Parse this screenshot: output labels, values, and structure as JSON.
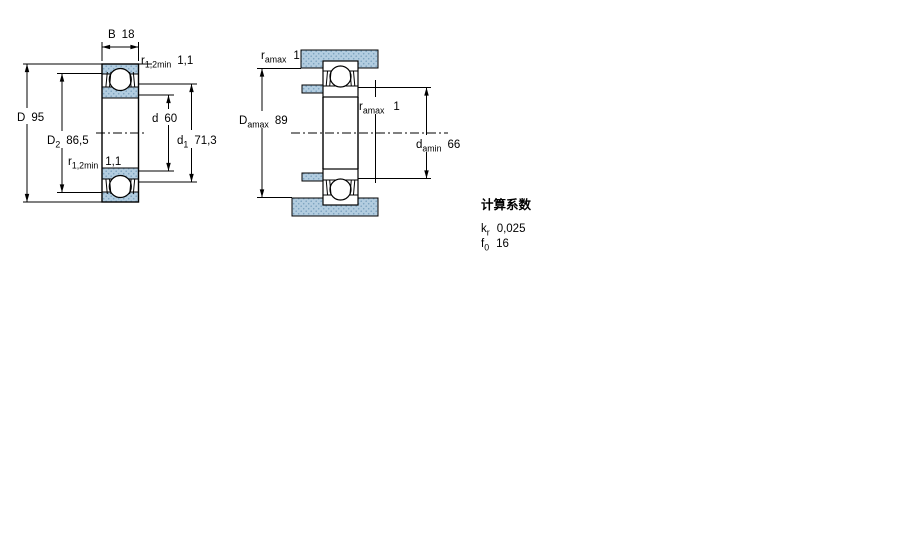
{
  "section_view": {
    "dims": {
      "B": {
        "symbol": "B",
        "subscript": "",
        "value": "18"
      },
      "r12_top": {
        "symbol": "r",
        "subscript": "1,2min",
        "value": "1,1"
      },
      "D": {
        "symbol": "D",
        "subscript": "",
        "value": "95"
      },
      "D2": {
        "symbol": "D",
        "subscript": "2",
        "value": "86,5"
      },
      "r12_bot": {
        "symbol": "r",
        "subscript": "1,2min",
        "value": "1,1"
      },
      "d": {
        "symbol": "d",
        "subscript": "",
        "value": "60"
      },
      "d1": {
        "symbol": "d",
        "subscript": "1",
        "value": "71,3"
      }
    }
  },
  "mounting_view": {
    "dims": {
      "ramax_top": {
        "symbol": "r",
        "subscript": "amax",
        "value": "1"
      },
      "Damax": {
        "symbol": "D",
        "subscript": "amax",
        "value": "89"
      },
      "ramax_mid": {
        "symbol": "r",
        "subscript": "amax",
        "value": "1"
      },
      "damin": {
        "symbol": "d",
        "subscript": "amin",
        "value": "66"
      }
    }
  },
  "factors": {
    "title": "计算系数",
    "rows": [
      {
        "symbol": "k",
        "subscript": "r",
        "value": "0,025"
      },
      {
        "symbol": "f",
        "subscript": "0",
        "value": "16"
      }
    ]
  },
  "colors": {
    "fill_blue": "#b3cde0",
    "fill_dot": "#7ba3c0",
    "line": "#000000"
  }
}
